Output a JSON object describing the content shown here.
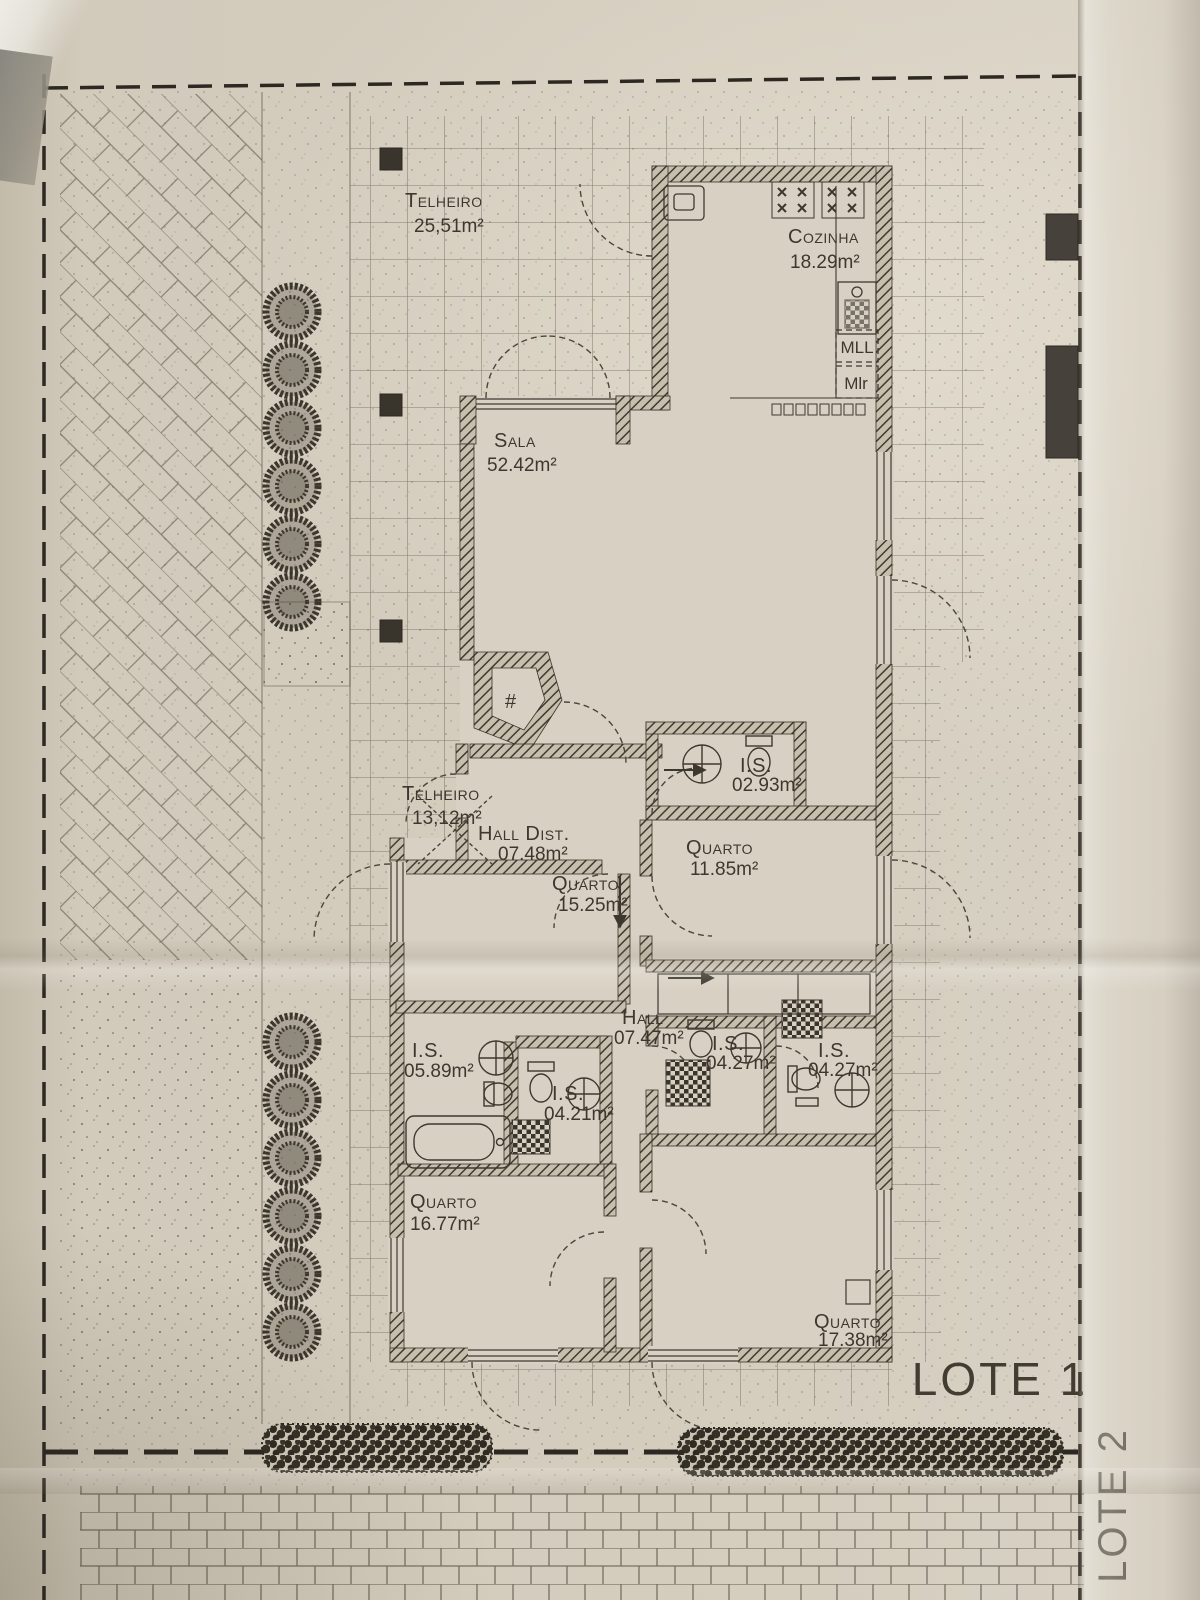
{
  "site": {
    "lot1_label": "LOTE 1",
    "lot2_label": "LOTE 2"
  },
  "rooms": [
    {
      "name": "Telheiro",
      "area": "25,51m²"
    },
    {
      "name": "Cozinha",
      "area": "18.29m²"
    },
    {
      "name": "Sala",
      "area": "52.42m²"
    },
    {
      "name": "Telheiro",
      "area": "13,12m²"
    },
    {
      "name": "Hall Dist.",
      "area": "07.48m²"
    },
    {
      "name": "Quarto",
      "area": "15.25m²"
    },
    {
      "name": "Quarto",
      "area": "11.85m²"
    },
    {
      "name": "I.S.",
      "area": "02.93m²"
    },
    {
      "name": "I.S.",
      "area": "05.89m²"
    },
    {
      "name": "I.S.",
      "area": "04.21m²"
    },
    {
      "name": "Hall",
      "area": "07.47m²"
    },
    {
      "name": "I.S.",
      "area": "04.27m²"
    },
    {
      "name": "I.S.",
      "area": "04.27m²"
    },
    {
      "name": "Quarto",
      "area": "16.77m²"
    },
    {
      "name": "Quarto",
      "area": "17.38m²"
    }
  ],
  "kitchen": {
    "washing_machine_label": "MLL",
    "dryer_label": "Mlr"
  },
  "symbols": {
    "fireplace_mark": "#"
  },
  "colors": {
    "paper": "#d5cebf",
    "ink": "#3d382f",
    "wall_hatch": "#403a30"
  }
}
